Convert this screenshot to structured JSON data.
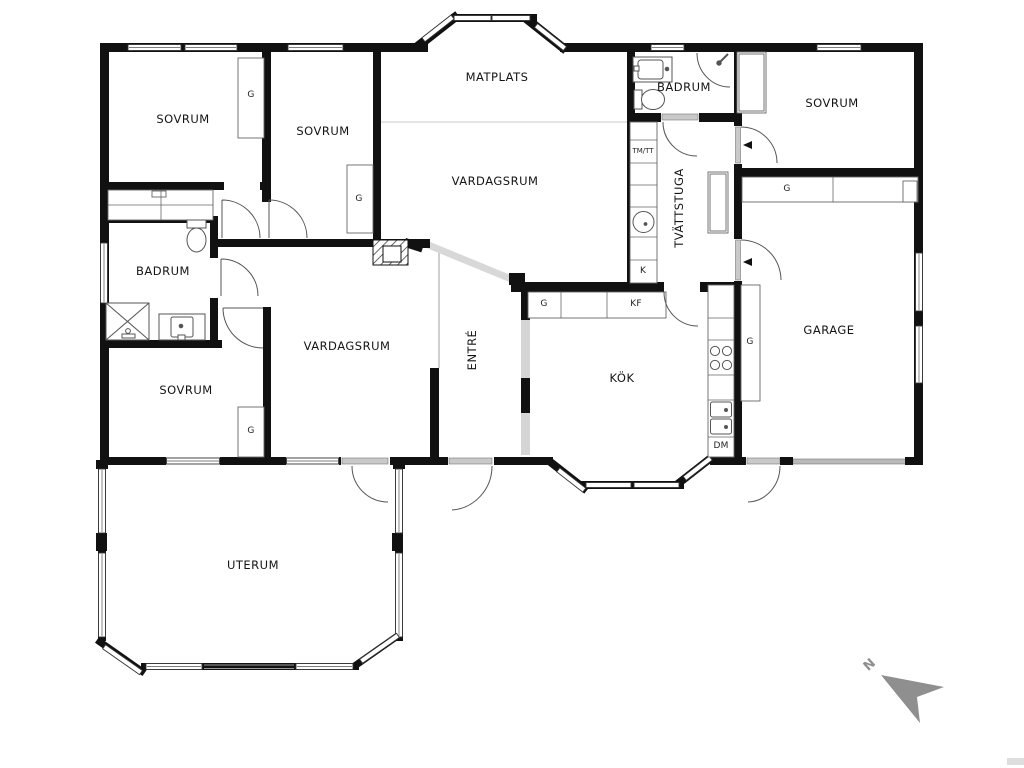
{
  "floorplan": {
    "labels": {
      "bedroom": "SOVRUM",
      "dining_area": "MATPLATS",
      "living_room": "VARDAGSRUM",
      "bathroom": "BADRUM",
      "laundry_room": "TVÄTTSTUGA",
      "kitchen": "KÖK",
      "entry": "ENTRÉ",
      "garage": "GARAGE",
      "conservatory": "UTERUM",
      "wardrobe": "G",
      "washer_dryer": "TM/TT",
      "fridge": "K",
      "fridge_freezer": "KF",
      "dishwasher": "DM",
      "compass_north": "N"
    },
    "colors": {
      "wall": "#111111",
      "compass": "#8f8f8f",
      "door_panel": "#c9c9c9",
      "glass_partition": "#d8d8d8"
    }
  }
}
